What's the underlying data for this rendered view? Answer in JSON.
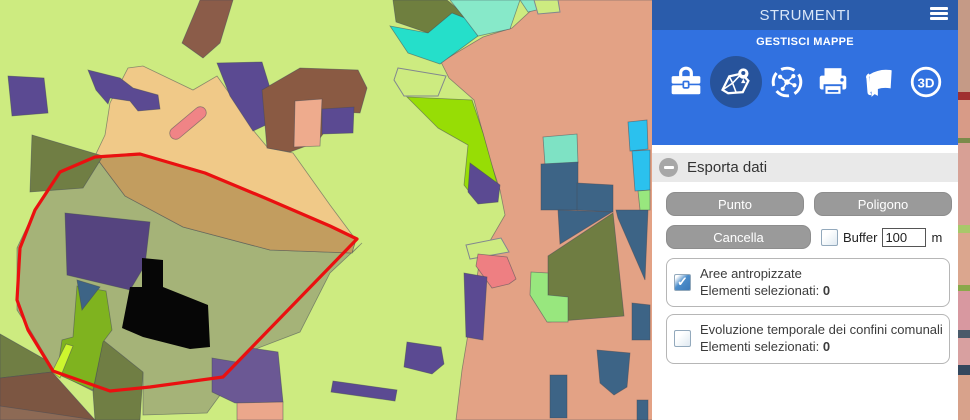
{
  "map": {
    "background_color": "#cdeb80",
    "selection_outline_color": "#ea1010"
  },
  "panel": {
    "title": "STRUMENTI",
    "subtitle": "GESTISCI MAPPE",
    "colors": {
      "header_bg": "#2a5cab",
      "toolbar_bg": "#3171e0",
      "selected_tool_bg": "#27539b",
      "section_bg": "#e9e9e9",
      "button_bg": "#9a9a9a"
    },
    "tools": [
      {
        "name": "toolbox-icon"
      },
      {
        "name": "map-layers-icon",
        "selected": true
      },
      {
        "name": "network-icon"
      },
      {
        "name": "print-icon"
      },
      {
        "name": "book-icon"
      },
      {
        "name": "threed-icon",
        "label": "3D"
      }
    ],
    "section": {
      "title": "Esporta dati"
    },
    "export": {
      "punto_label": "Punto",
      "poligono_label": "Poligono",
      "cancella_label": "Cancella",
      "buffer_checked": false,
      "buffer_label": "Buffer",
      "buffer_value": "100",
      "buffer_unit": "m",
      "layers": [
        {
          "name": "Aree antropizzate",
          "selected_label": "Elementi selezionati:",
          "selected_count": "0",
          "checked": true
        },
        {
          "name": "Evoluzione temporale dei confini comunali",
          "selected_label": "Elementi selezionati:",
          "selected_count": "0",
          "checked": false
        }
      ]
    }
  }
}
